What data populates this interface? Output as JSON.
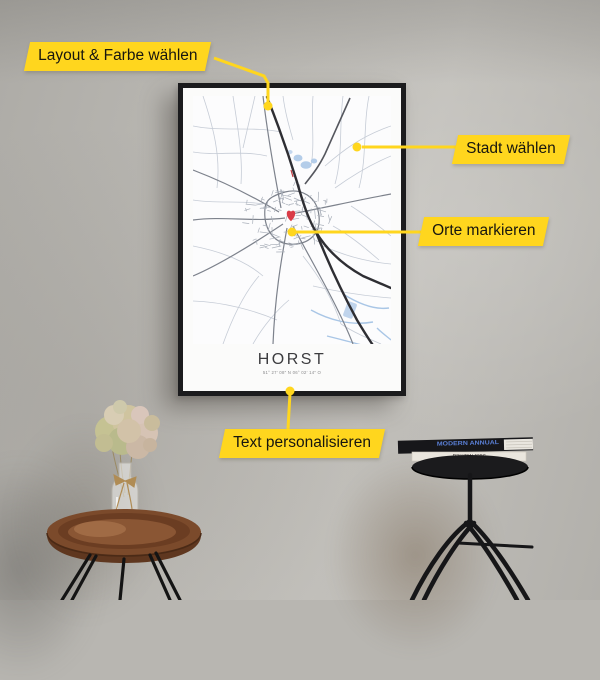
{
  "callouts": {
    "layout": {
      "label": "Layout & Farbe wählen"
    },
    "stadt": {
      "label": "Stadt wählen"
    },
    "orte": {
      "label": "Orte markieren"
    },
    "text": {
      "label": "Text personalisieren"
    }
  },
  "poster": {
    "title": "HORST",
    "coordinates": "51° 27′ 08″ N   06° 02′ 14″ O"
  },
  "books": {
    "top_spine": "MODERN ANNUAL",
    "bottom_spine": "Just Married"
  },
  "colors": {
    "accent_yellow": "#FFD61E",
    "heart_red": "#D93B47",
    "frame_black": "#1B1B1D",
    "water_blue": "#A9C6E6",
    "wall_gray": "#B8B6B1"
  }
}
